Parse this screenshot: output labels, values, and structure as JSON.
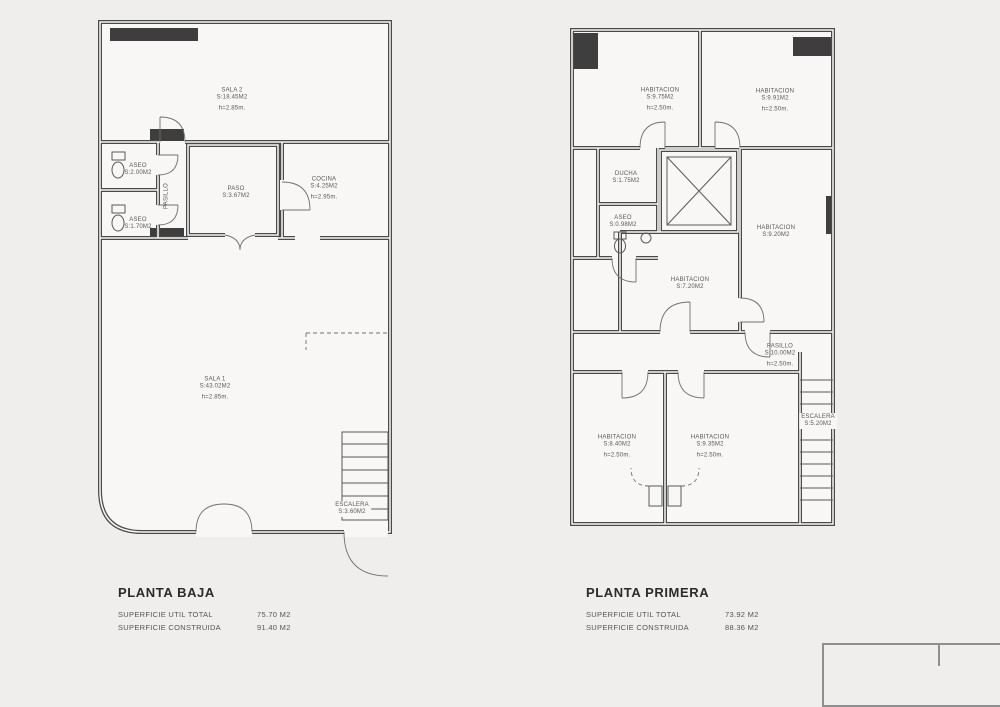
{
  "page": {
    "background": "#efeeec",
    "plan_fill": "#f8f7f5",
    "wall_color": "#4a4a4a",
    "dark_wall_color": "#3e3e3e",
    "label_color": "#585858"
  },
  "plans": [
    {
      "id": "planta-baja",
      "title": "PLANTA BAJA",
      "stats": [
        {
          "label": "SUPERFICIE UTIL TOTAL",
          "value": "75.70 M2"
        },
        {
          "label": "SUPERFICIE CONSTRUIDA",
          "value": "91.40 M2"
        }
      ],
      "rooms": [
        {
          "name": "SALA 2",
          "area": "S:18.45M2",
          "height": "h=2.85m."
        },
        {
          "name": "PASO",
          "area": "S:3.67M2"
        },
        {
          "name": "COCINA",
          "area": "S:4.25M2",
          "height": "h=2.95m."
        },
        {
          "name": "ASEO",
          "area": "S:2.00M2"
        },
        {
          "name": "ASEO",
          "area": "S:1.70M2"
        },
        {
          "name": "PASILLO"
        },
        {
          "name": "SALA 1",
          "area": "S:43.02M2",
          "height": "h=2.85m."
        },
        {
          "name": "ESCALERA",
          "area": "S:3.60M2"
        }
      ]
    },
    {
      "id": "planta-primera",
      "title": "PLANTA PRIMERA",
      "stats": [
        {
          "label": "SUPERFICIE UTIL TOTAL",
          "value": "73.92 M2"
        },
        {
          "label": "SUPERFICIE CONSTRUIDA",
          "value": "88.36 M2"
        }
      ],
      "rooms": [
        {
          "name": "HABITACION",
          "area": "S:9.75M2",
          "height": "h=2.50m."
        },
        {
          "name": "HABITACION",
          "area": "S:9.91M2",
          "height": "h=2.50m."
        },
        {
          "name": "DUCHA",
          "area": "S:1.75M2"
        },
        {
          "name": "ASEO",
          "area": "S:0.98M2"
        },
        {
          "name": "HABITACION",
          "area": "S:7.20M2"
        },
        {
          "name": "HABITACION",
          "area": "S:9.20M2"
        },
        {
          "name": "PASILLO",
          "area": "S:10.00M2",
          "height": "h=2.50m."
        },
        {
          "name": "HABITACION",
          "area": "S:8.40M2",
          "height": "h=2.50m."
        },
        {
          "name": "HABITACION",
          "area": "S:9.35M2",
          "height": "h=2.50m."
        },
        {
          "name": "ESCALERA",
          "area": "S:5.20M2"
        }
      ]
    }
  ]
}
